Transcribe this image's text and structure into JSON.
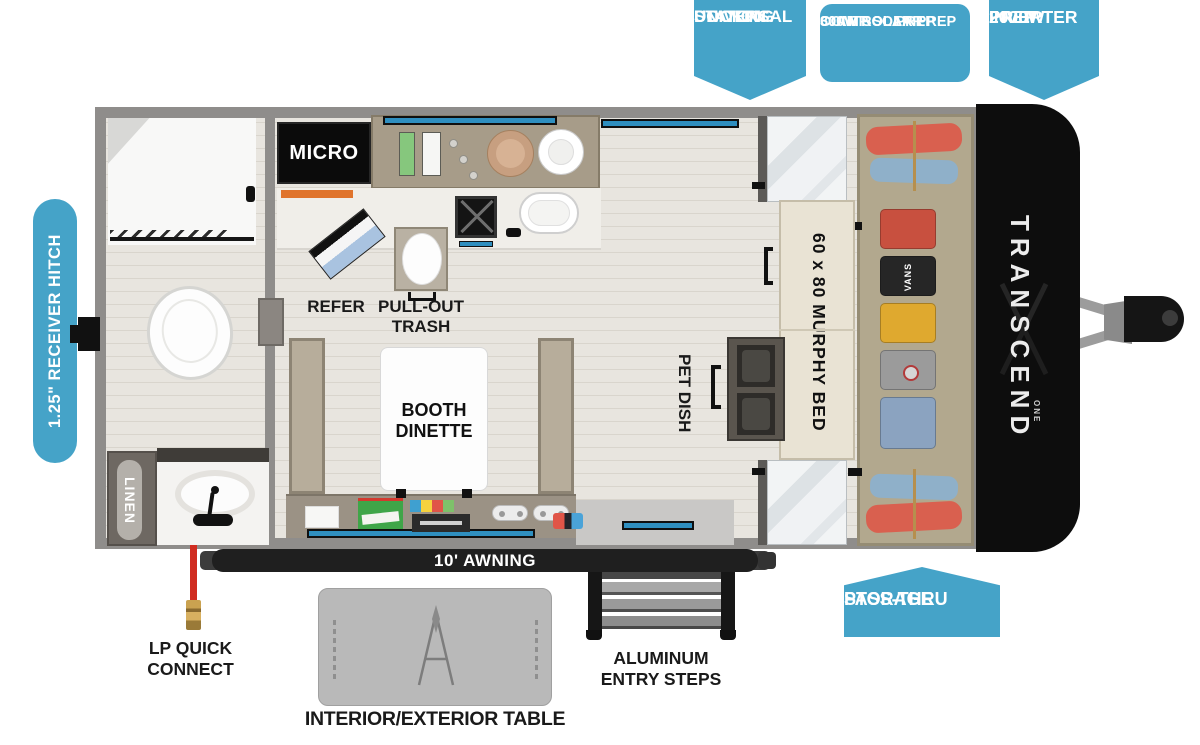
{
  "callouts": {
    "docking": {
      "l1": "UNIVERSAL",
      "l2": "DOCKING",
      "l3": "STATION"
    },
    "solar": {
      "l1": "600W SOLAR PREP",
      "l2": "30AMP SOLAR",
      "l3": "CONTROL PREP"
    },
    "inverter": {
      "l1": "2000W",
      "l2": "INVERTER",
      "l3": "PREP"
    },
    "passthru": {
      "l1": "PASS-THRU",
      "l2": "STORAGE"
    },
    "hitch": "1.25\" RECEIVER HITCH"
  },
  "floorplan": {
    "micro": "MICRO",
    "refer": "REFER",
    "trash_l1": "PULL-OUT",
    "trash_l2": "TRASH",
    "dinette_l1": "BOOTH",
    "dinette_l2": "DINETTE",
    "pet_dish": "PET DISH",
    "murphy_bed": "60 x 80 MURPHY BED",
    "linen": "LINEN",
    "shirt_brand": "VANS",
    "brand": "TRANSCEND",
    "brand_sub": "ONE"
  },
  "exterior": {
    "awning": "10' AWNING",
    "lp_l1": "LP QUICK",
    "lp_l2": "CONNECT",
    "table": "INTERIOR/EXTERIOR TABLE",
    "steps_l1": "ALUMINUM",
    "steps_l2": "ENTRY STEPS"
  },
  "colors": {
    "callout_blue": "#45a3c8",
    "wall_gray": "#8f8d8b",
    "floor": "#e8e5df",
    "counter_taupe": "#a79c89",
    "bed_cream": "#e9e3d4",
    "sofa_tan": "#b2a88e",
    "front_cap_black": "#0d0d0d",
    "accent_orange": "#e0742c",
    "window_blue": "#2f8fc0",
    "lp_red": "#d02c20"
  }
}
